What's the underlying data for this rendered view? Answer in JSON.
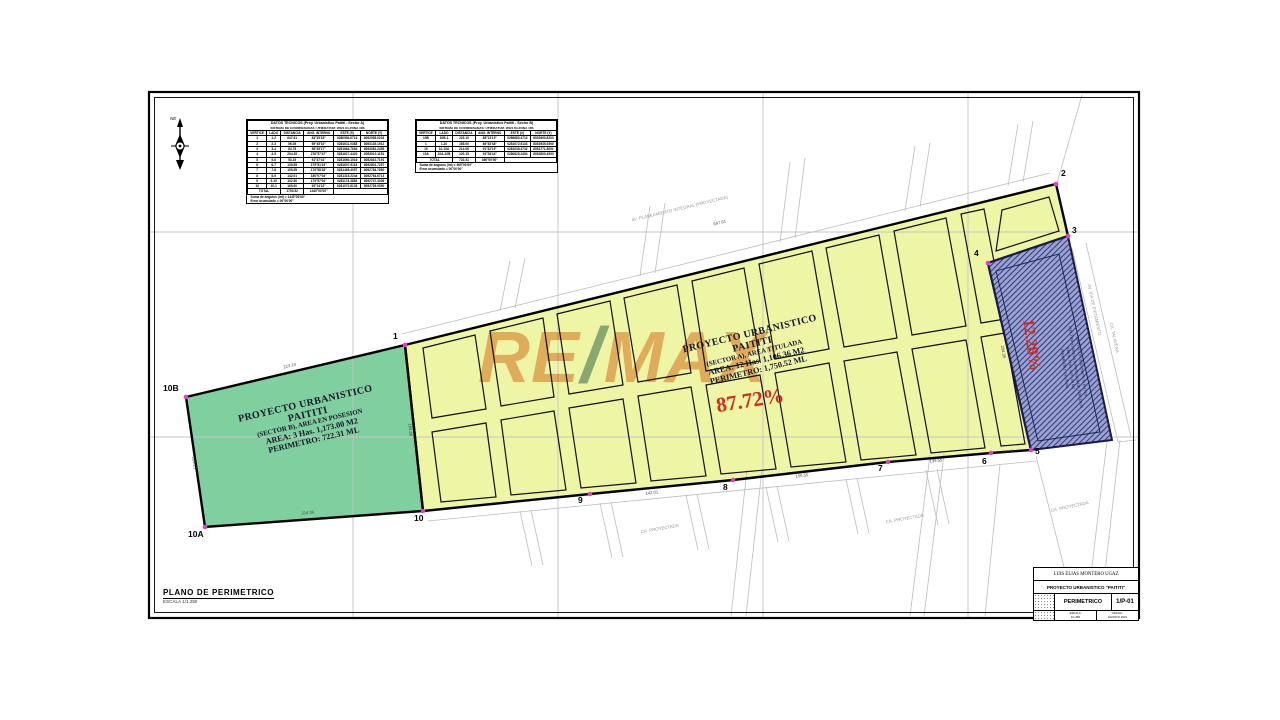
{
  "colors": {
    "green": "#7fcf9f",
    "yellow": "#eef6a6",
    "blue_base": "#9aa2d4",
    "blue_line": "#262c66",
    "magenta": "#e23ad2",
    "red": "#d42a1e",
    "watermark_tan": "#eca270",
    "watermark_slash": "#7a9999"
  },
  "north": {
    "label": "NE"
  },
  "watermark": {
    "re": "RE",
    "slash": "/",
    "max": "MAX",
    "reg": "®"
  },
  "tables": {
    "a": {
      "title": "DATOS TECNICOS (Proy. Urbanistico Paititi - Sector A)",
      "subtitle": "SISTEMA DE COORDENADAS: UTM/DATUM: WGS 84-ZONA 18S",
      "columns": [
        "VERTICE",
        "LADO",
        "DISTANCIA",
        "ANG. INTERNO",
        "ESTE (X)",
        "NORTE (Y)"
      ],
      "rows": [
        [
          "1",
          "1-2",
          "647.61",
          "83°35'18\"",
          "0280954.0713",
          "8052955.0203"
        ],
        [
          "2",
          "2-3",
          "56.05",
          "95°45'10\"",
          "0281611.0368",
          "8053135.1912"
        ],
        [
          "3",
          "3-4",
          "84.75",
          "98°45'17\"",
          "0281664.7664",
          "8053081.2455"
        ],
        [
          "4",
          "4-5",
          "204.35",
          "276°57'47\"",
          "0281617.4423",
          "8053010.1151"
        ],
        [
          "5",
          "5-6",
          "53.15",
          "91°47'41\"",
          "0281660.1516",
          "8052810.7191"
        ],
        [
          "6",
          "6-7",
          "139.55",
          "179°51'19\"",
          "0281607.9118",
          "8052801.7257"
        ],
        [
          "7",
          "7-8",
          "155.55",
          "179°58'18\"",
          "0281469.4057",
          "8052784.7850"
        ],
        [
          "8",
          "8-9",
          "142.01",
          "180°07'04\"",
          "0281315.2244",
          "8052764.6713"
        ],
        [
          "9",
          "9-10",
          "102.50",
          "179°57'04\"",
          "0281174.3884",
          "8052747.3306"
        ],
        [
          "10",
          "10-1",
          "165.00",
          "93°14'22\"",
          "0281072.6133",
          "8052735.0590"
        ]
      ],
      "total_label": "TOTAL",
      "total_distance": "1750.52",
      "sum_label": "Suma de ángulos (int) =",
      "sum_value": "1440°00'00\"",
      "err_label": "Error acumulado =",
      "err_value": "00°00'00\""
    },
    "b": {
      "title": "DATOS TECNICOS (Proy. Urbanistico Paititi - Sector B)",
      "subtitle": "SISTEMA DE COORDENADAS: UTM/DATUM: WGS 84-ZONA 18S",
      "columns": [
        "VERTICE",
        "LADO",
        "DISTANCIA",
        "ANG. INTERNO",
        "ESTE (X)",
        "NORTE (Y)"
      ],
      "rows": [
        [
          "10B",
          "10B-1",
          "223.10",
          "88°13'19\"",
          "0280880.4713",
          "8052990.8203"
        ],
        [
          "1",
          "1-10",
          "165.00",
          "86°45'38\"",
          "0281072.6133",
          "8052935.0590"
        ],
        [
          "10",
          "10-10A",
          "214.06",
          "91°32'19\"",
          "0281038.4732",
          "8052771.5091"
        ],
        [
          "10A",
          "10A-10B",
          "120.15",
          "93°28'44\"",
          "0280825.2454",
          "8052800.4593"
        ]
      ],
      "total_label": "TOTAL",
      "total_distance": "722.31",
      "sum_label": "Suma de ángulos (int) =",
      "sum_value": "360°00'00\"",
      "err_label": "Error acumulado =",
      "err_value": "00°00'00\""
    }
  },
  "parcels": {
    "green": {
      "lines": [
        "PROYECTO URBANISTICO",
        "PAITITI",
        "(SECTOR B), AREA EN POSESION",
        "AREA: 3 Has. 1,173.00 M2",
        "PERIMETRO: 722.31 ML"
      ]
    },
    "yellow": {
      "lines": [
        "PROYECTO URBANISTICO",
        "PAITITI",
        "(SECTOR A), AREA TITULADA",
        "AREA: 12 Has. 1,106.36 M2",
        "PERIMETRO: 1,750.52 ML"
      ],
      "percent": "87.72%"
    },
    "blue": {
      "lines": [
        "PROYECTO URBANISTICO PAITITI",
        "(SECTOR A) AREA EN POSESION DE TERCEROS",
        "AREA: 1 Has. 4,871.86 M2",
        "PERIMETRO: 545.00 ML"
      ],
      "percent": "12.28%"
    }
  },
  "vertices": [
    "1",
    "2",
    "3",
    "4",
    "5",
    "6",
    "7",
    "8",
    "9",
    "10",
    "10A",
    "10B"
  ],
  "edge_labels": [
    "223.10",
    "120.15",
    "214.06",
    "165.00",
    "647.61",
    "142.01",
    "155.55",
    "139.55",
    "53.15",
    "204.35"
  ],
  "street_labels": [
    "AV. PLANEAMIENTO INTEGRAL (PROYECTADA)",
    "AV. VIA DE EVITAMIENTO",
    "CA. TALAVERA",
    "CA. PROYECTADA",
    "CA. PROYECTADA",
    "CA. PROYECTADA"
  ],
  "footer": {
    "plan_title": "PLANO DE PERIMETRICO",
    "scale": "ESCALA 1/1,250"
  },
  "title_block": {
    "owner": "LUIS ELIAS MONTERO UGAZ",
    "project": "PROYECTO URBANISTICO \"PAITITI\"",
    "sheet_name": "PERIMETRICO",
    "sheet_no": "1/P-01",
    "meta1a": "ESCALA:",
    "meta1b": "1/1,250",
    "meta2a": "FECHA:",
    "meta2b": "AGOSTO 2021"
  }
}
